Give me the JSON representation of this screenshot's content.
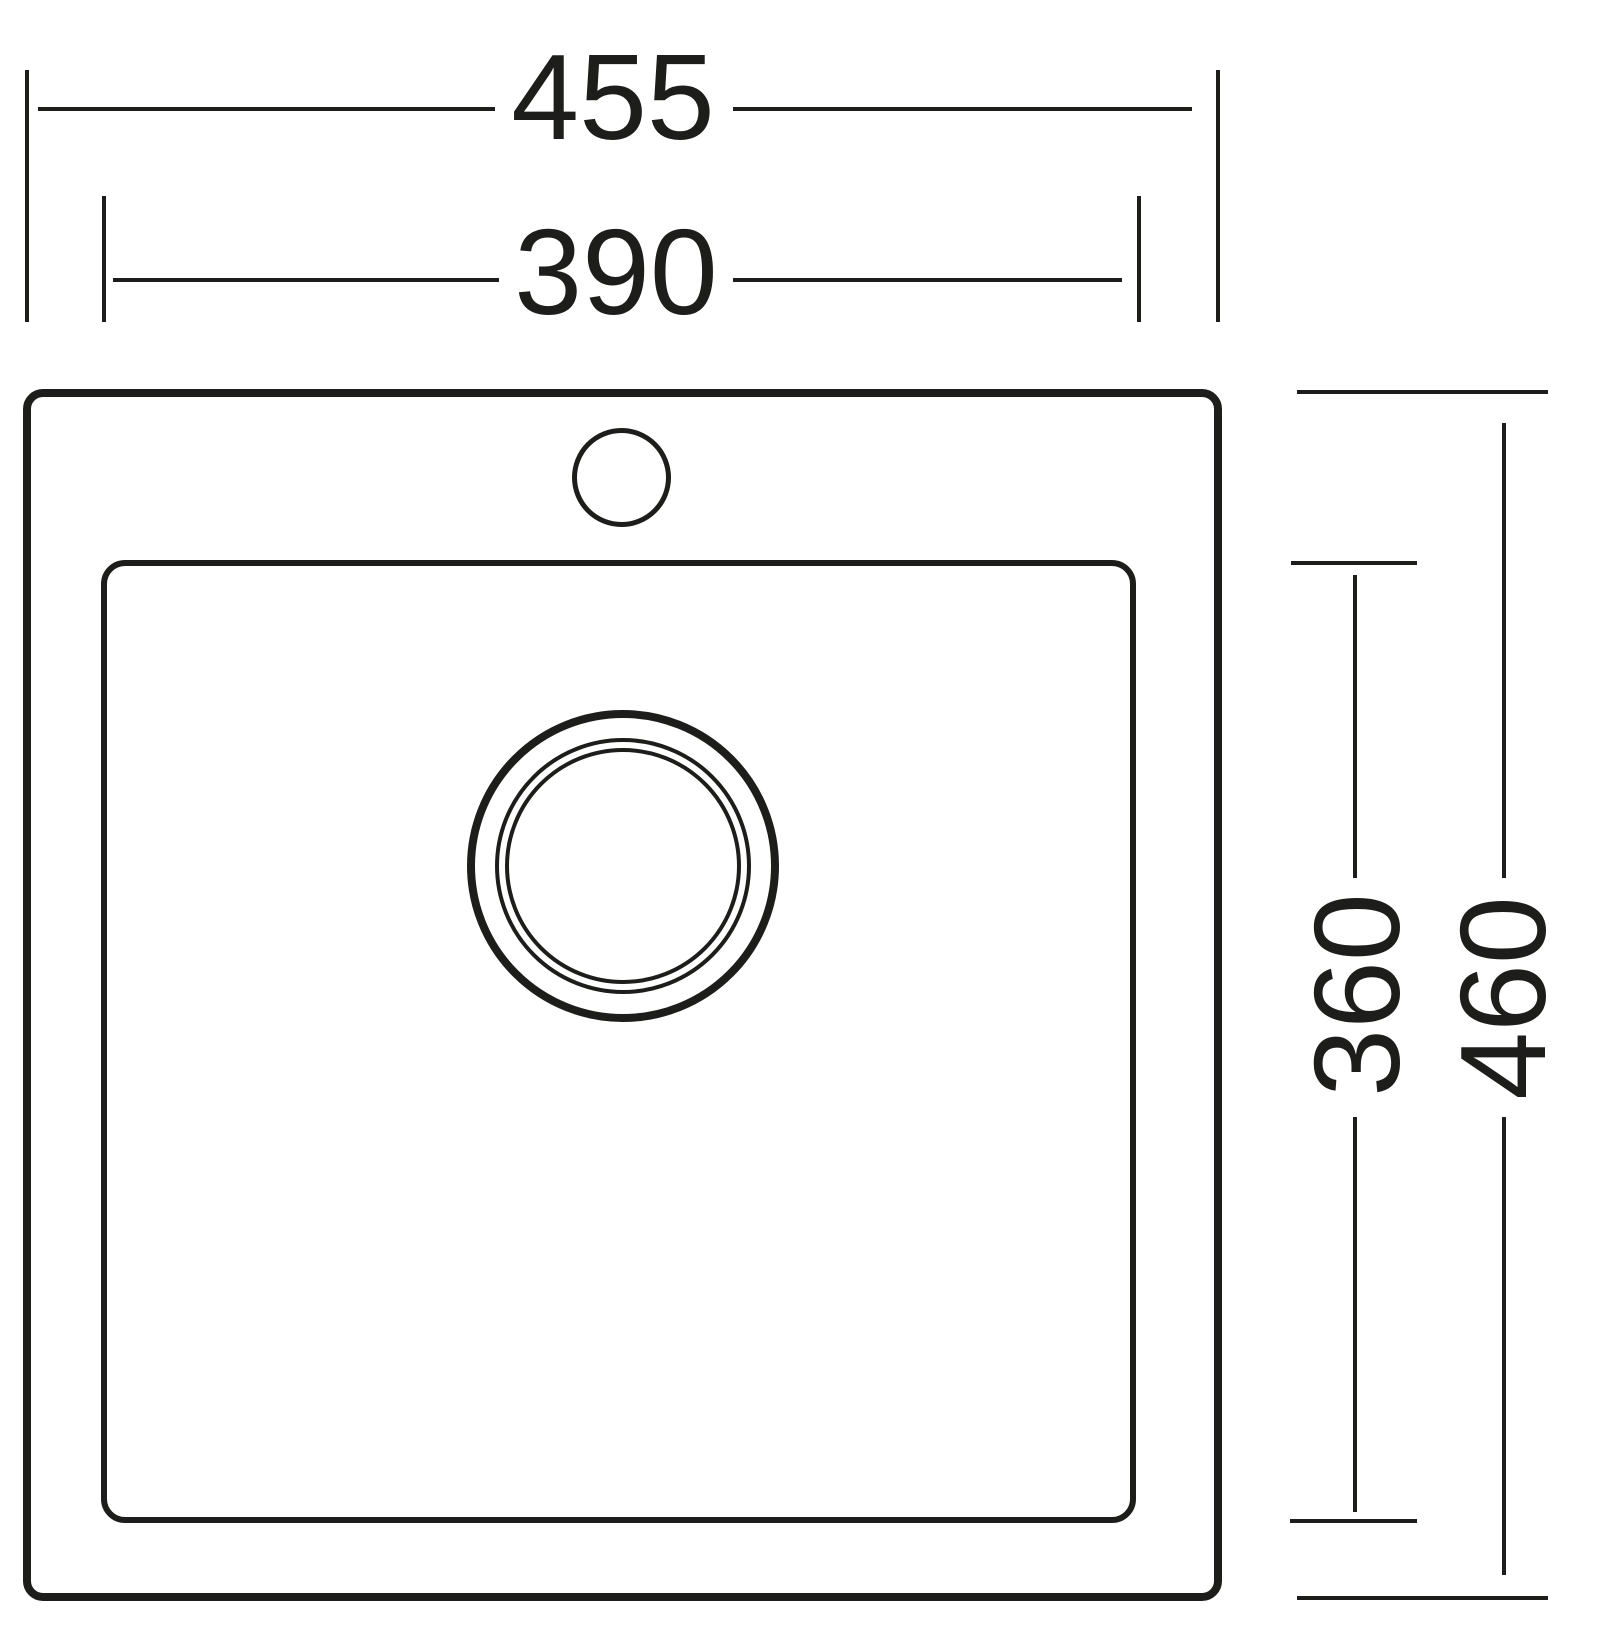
{
  "drawing": {
    "line_color": "#1d1d1b",
    "background_color": "#ffffff",
    "dimensions": {
      "overall_width": "455",
      "bowl_width": "390",
      "bowl_depth": "360",
      "overall_depth": "460"
    }
  }
}
